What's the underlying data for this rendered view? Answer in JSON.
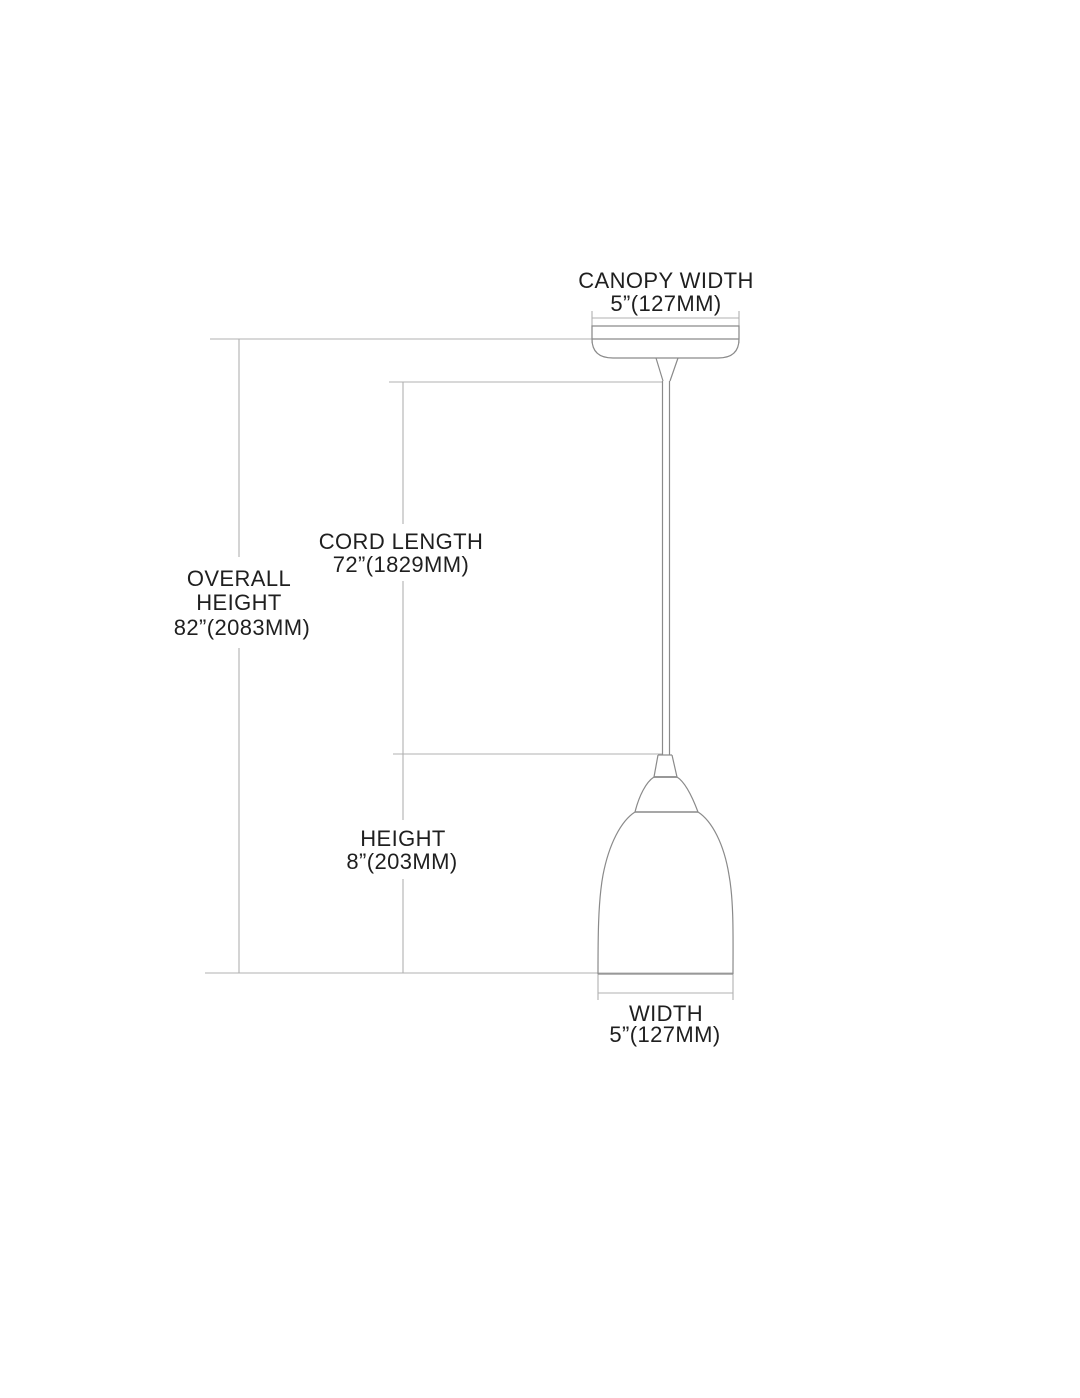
{
  "diagram": {
    "colors": {
      "background": "#ffffff",
      "dimension_line": "#b0b0b0",
      "outline": "#8a8a8a",
      "text": "#1f1f1f"
    },
    "dimensions": {
      "canopy_width": {
        "label": "CANOPY WIDTH",
        "value": "5”(127MM)"
      },
      "overall_height": {
        "label_line1": "OVERALL",
        "label_line2": "HEIGHT",
        "value": "82”(2083MM)"
      },
      "cord_length": {
        "label": "CORD LENGTH",
        "value": "72”(1829MM)"
      },
      "height": {
        "label": "HEIGHT",
        "value": "8”(203MM)"
      },
      "width": {
        "label": "WIDTH",
        "value": "5”(127MM)"
      }
    }
  }
}
